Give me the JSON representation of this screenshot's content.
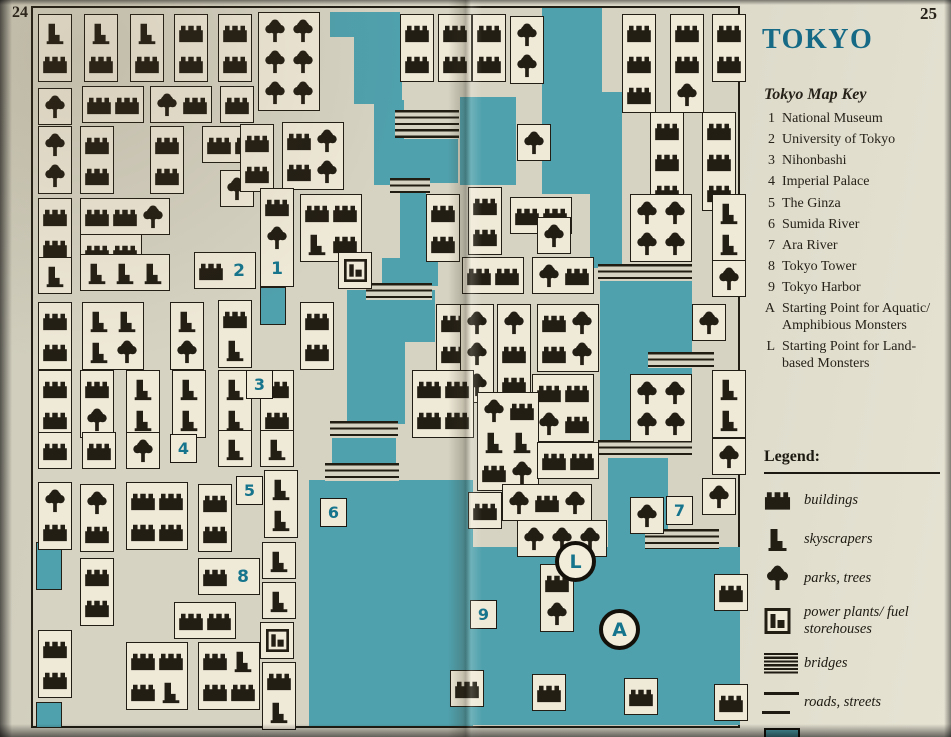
{
  "page": {
    "left_number": "24",
    "right_number": "25"
  },
  "title": "TOKYO",
  "map_key": {
    "heading": "Tokyo Map Key",
    "entries": [
      {
        "id": "1",
        "label": "National Museum"
      },
      {
        "id": "2",
        "label": "University of Tokyo"
      },
      {
        "id": "3",
        "label": "Nihonbashi"
      },
      {
        "id": "4",
        "label": "Imperial Palace"
      },
      {
        "id": "5",
        "label": "The Ginza"
      },
      {
        "id": "6",
        "label": "Sumida River"
      },
      {
        "id": "7",
        "label": "Ara River"
      },
      {
        "id": "8",
        "label": "Tokyo Tower"
      },
      {
        "id": "9",
        "label": "Tokyo Harbor"
      },
      {
        "id": "A",
        "label": "Starting Point for Aquatic/ Amphibious Monsters"
      },
      {
        "id": "L",
        "label": "Starting Point for Land-based Monsters"
      }
    ]
  },
  "legend": {
    "heading": "Legend:",
    "items": [
      {
        "icon": "building-icon",
        "label": "buildings"
      },
      {
        "icon": "skyscraper-icon",
        "label": "skyscrapers"
      },
      {
        "icon": "tree-icon",
        "label": "parks, trees"
      },
      {
        "icon": "power-plant-icon",
        "label": "power plants/ fuel storehouses"
      },
      {
        "icon": "bridge-icon",
        "label": "bridges"
      },
      {
        "icon": "road-icon",
        "label": "roads, streets"
      },
      {
        "icon": "water-icon",
        "label": "water"
      }
    ]
  },
  "colors": {
    "water": "#4fa1ad",
    "paper": "#d6d3c3",
    "block": "#efe9d8",
    "ink": "#221e15",
    "accent_teal": "#16758c",
    "title_teal": "#176a85"
  },
  "map": {
    "origin": {
      "x": 31,
      "y": 6,
      "w": 709,
      "h": 722
    },
    "water": [
      [
        328,
        10,
        70,
        25
      ],
      [
        352,
        30,
        48,
        72
      ],
      [
        372,
        98,
        30,
        85
      ],
      [
        398,
        137,
        58,
        44
      ],
      [
        398,
        178,
        26,
        82
      ],
      [
        380,
        256,
        56,
        28
      ],
      [
        345,
        288,
        88,
        52
      ],
      [
        345,
        340,
        58,
        82
      ],
      [
        330,
        436,
        64,
        28
      ],
      [
        307,
        478,
        164,
        246
      ],
      [
        470,
        545,
        268,
        178
      ],
      [
        458,
        95,
        56,
        88
      ],
      [
        540,
        6,
        60,
        186
      ],
      [
        588,
        90,
        32,
        176
      ],
      [
        598,
        262,
        92,
        108
      ],
      [
        598,
        368,
        92,
        74
      ],
      [
        606,
        440,
        60,
        110
      ]
    ],
    "water_edged": [
      [
        284,
        12,
        22,
        20
      ],
      [
        258,
        285,
        26,
        38
      ],
      [
        34,
        540,
        26,
        48
      ],
      [
        34,
        700,
        26,
        26
      ]
    ],
    "bridges": [
      [
        393,
        108,
        64,
        28
      ],
      [
        388,
        176,
        40,
        15
      ],
      [
        364,
        281,
        66,
        17
      ],
      [
        328,
        419,
        68,
        16
      ],
      [
        323,
        461,
        74,
        18
      ],
      [
        596,
        262,
        94,
        17
      ],
      [
        646,
        350,
        66,
        16
      ],
      [
        596,
        438,
        94,
        18
      ],
      [
        643,
        527,
        74,
        20
      ]
    ],
    "blocks": [
      [
        36,
        12,
        1,
        "s,b"
      ],
      [
        82,
        12,
        1,
        "s,b"
      ],
      [
        128,
        12,
        1,
        "s,b"
      ],
      [
        172,
        12,
        1,
        "b,b"
      ],
      [
        216,
        12,
        1,
        "b,b"
      ],
      [
        256,
        10,
        2,
        "t,t,t,t,t,t"
      ],
      [
        398,
        12,
        1,
        "b,b"
      ],
      [
        436,
        12,
        1,
        "b,b"
      ],
      [
        470,
        12,
        1,
        "b,b"
      ],
      [
        508,
        14,
        1,
        "t,t"
      ],
      [
        620,
        12,
        1,
        "b,b,b"
      ],
      [
        668,
        12,
        1,
        "b,b,t"
      ],
      [
        710,
        12,
        1,
        "b,b"
      ],
      [
        36,
        86,
        1,
        "t"
      ],
      [
        80,
        84,
        2,
        "b,b"
      ],
      [
        148,
        84,
        2,
        "t,b"
      ],
      [
        218,
        84,
        1,
        "b"
      ],
      [
        648,
        110,
        1,
        "b,b,b"
      ],
      [
        700,
        110,
        1,
        "b,b,b"
      ],
      [
        515,
        122,
        1,
        "t"
      ],
      [
        36,
        124,
        1,
        "t,t"
      ],
      [
        78,
        124,
        1,
        "b,b"
      ],
      [
        148,
        124,
        1,
        "b,b"
      ],
      [
        200,
        124,
        2,
        "b,b"
      ],
      [
        218,
        168,
        1,
        "t"
      ],
      [
        238,
        122,
        1,
        "b,b"
      ],
      [
        280,
        120,
        2,
        "b,t,b,t"
      ],
      [
        36,
        196,
        1,
        "b,b"
      ],
      [
        78,
        196,
        3,
        "b,b,t"
      ],
      [
        78,
        232,
        2,
        "b,b"
      ],
      [
        258,
        186,
        1,
        "b,t,#1"
      ],
      [
        298,
        192,
        2,
        "b,b,s,b"
      ],
      [
        424,
        192,
        1,
        "b,b"
      ],
      [
        466,
        185,
        1,
        "b,b"
      ],
      [
        508,
        195,
        2,
        "b,b"
      ],
      [
        535,
        215,
        1,
        "t"
      ],
      [
        628,
        192,
        2,
        "t,t,t,t"
      ],
      [
        710,
        192,
        1,
        "s,s"
      ],
      [
        36,
        255,
        1,
        "s"
      ],
      [
        78,
        252,
        3,
        "s,s,s"
      ],
      [
        192,
        250,
        2,
        "b,#2"
      ],
      [
        336,
        250,
        1,
        "p"
      ],
      [
        460,
        255,
        2,
        "b,b"
      ],
      [
        530,
        255,
        2,
        "t,b"
      ],
      [
        710,
        258,
        1,
        "t"
      ],
      [
        36,
        300,
        1,
        "b,b"
      ],
      [
        80,
        300,
        2,
        "s,s,s,t"
      ],
      [
        168,
        300,
        1,
        "s,t"
      ],
      [
        216,
        298,
        1,
        "b,s"
      ],
      [
        298,
        300,
        1,
        "b,b"
      ],
      [
        434,
        302,
        1,
        "b,b"
      ],
      [
        458,
        302,
        1,
        "t,t,t"
      ],
      [
        495,
        302,
        1,
        "t,b,b"
      ],
      [
        535,
        302,
        2,
        "b,t,b,t"
      ],
      [
        690,
        302,
        1,
        "t"
      ],
      [
        36,
        368,
        1,
        "b,b"
      ],
      [
        78,
        368,
        1,
        "b,t"
      ],
      [
        124,
        368,
        1,
        "s,s"
      ],
      [
        170,
        368,
        1,
        "s,s"
      ],
      [
        216,
        368,
        1,
        "s,s"
      ],
      [
        258,
        368,
        1,
        "b,b"
      ],
      [
        410,
        368,
        2,
        "b,b,b,b"
      ],
      [
        530,
        372,
        2,
        "b,b,t,b"
      ],
      [
        710,
        368,
        1,
        "s,s"
      ],
      [
        628,
        372,
        2,
        "t,t,t,t"
      ],
      [
        36,
        430,
        1,
        "b"
      ],
      [
        80,
        430,
        1,
        "b"
      ],
      [
        124,
        430,
        1,
        "t"
      ],
      [
        216,
        428,
        1,
        "s"
      ],
      [
        258,
        428,
        1,
        "s"
      ],
      [
        475,
        390,
        2,
        "t,b,s,s,b,t"
      ],
      [
        535,
        440,
        2,
        "b,b"
      ],
      [
        710,
        436,
        1,
        "t"
      ],
      [
        262,
        468,
        1,
        "s,s"
      ],
      [
        36,
        480,
        1,
        "t,b"
      ],
      [
        78,
        482,
        1,
        "t,b"
      ],
      [
        124,
        480,
        2,
        "b,b,b,b"
      ],
      [
        196,
        482,
        1,
        "b,b"
      ],
      [
        466,
        490,
        1,
        "b"
      ],
      [
        500,
        482,
        3,
        "t,b,t"
      ],
      [
        515,
        518,
        3,
        "t,t,t"
      ],
      [
        628,
        495,
        1,
        "t"
      ],
      [
        700,
        476,
        1,
        "t"
      ],
      [
        260,
        540,
        1,
        "s"
      ],
      [
        196,
        556,
        2,
        "b,#8"
      ],
      [
        78,
        556,
        1,
        "b,b"
      ],
      [
        260,
        580,
        1,
        "s"
      ],
      [
        258,
        620,
        1,
        "p"
      ],
      [
        260,
        660,
        1,
        "b,s"
      ],
      [
        172,
        600,
        2,
        "b,b"
      ],
      [
        36,
        628,
        1,
        "b,b"
      ],
      [
        124,
        640,
        2,
        "b,b,b,s"
      ],
      [
        196,
        640,
        2,
        "b,s,b,b"
      ],
      [
        538,
        562,
        1,
        "b,t"
      ],
      [
        712,
        572,
        1,
        "b"
      ],
      [
        712,
        682,
        1,
        "b"
      ],
      [
        448,
        668,
        1,
        "b"
      ],
      [
        530,
        672,
        1,
        "b"
      ],
      [
        622,
        676,
        1,
        "b"
      ]
    ],
    "markers": [
      {
        "label": "3",
        "x": 244,
        "y": 368,
        "shape": "square"
      },
      {
        "label": "4",
        "x": 168,
        "y": 432,
        "shape": "square"
      },
      {
        "label": "5",
        "x": 234,
        "y": 474,
        "shape": "square"
      },
      {
        "label": "6",
        "x": 318,
        "y": 496,
        "shape": "square"
      },
      {
        "label": "7",
        "x": 664,
        "y": 494,
        "shape": "square"
      },
      {
        "label": "9",
        "x": 468,
        "y": 598,
        "shape": "square"
      },
      {
        "label": "L",
        "x": 553,
        "y": 539,
        "shape": "circle"
      },
      {
        "label": "A",
        "x": 597,
        "y": 607,
        "shape": "circle"
      }
    ]
  }
}
